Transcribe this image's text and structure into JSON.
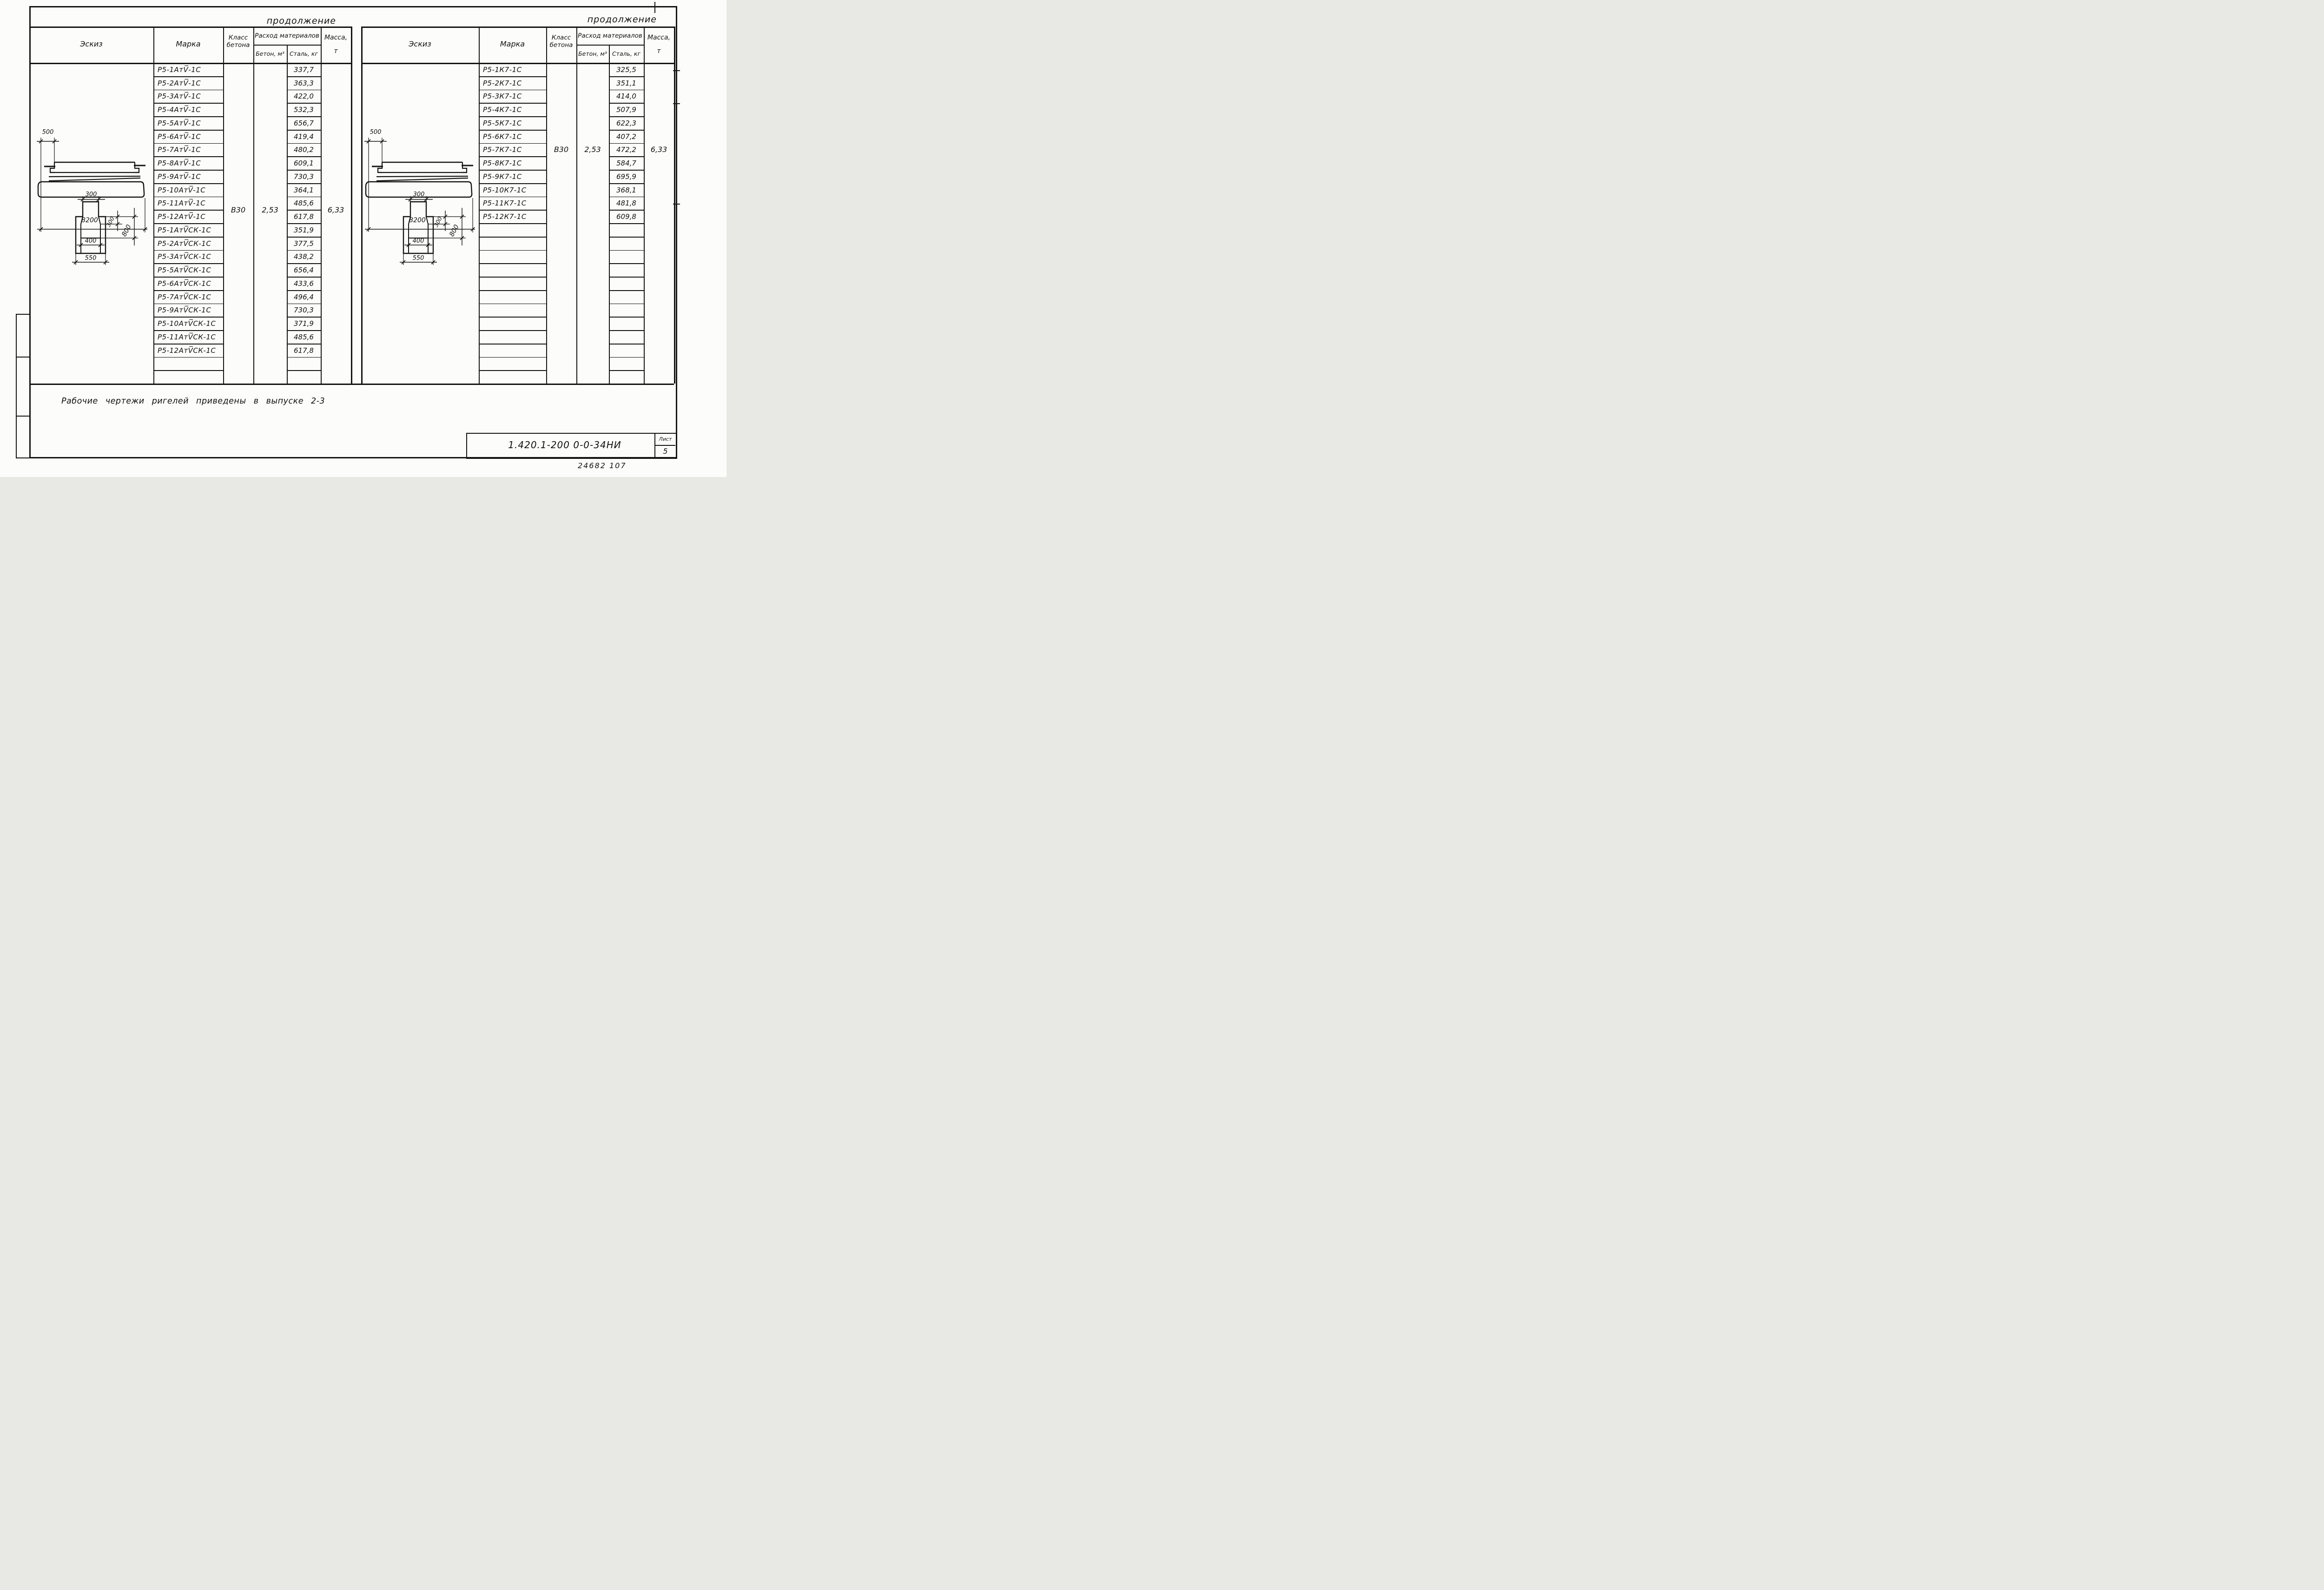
{
  "page": {
    "continuation_label": "продолжение",
    "note": "Рабочие  чертежи  ригелей  приведены  в  выпуске 2-3",
    "title_block": {
      "document_number": "1.420.1-200 0-0-34НИ",
      "sheet_label": "Лист",
      "sheet_number": "5",
      "stamp": "24682  107"
    }
  },
  "table_headers": {
    "sketch": "Эскиз",
    "mark": "Марка",
    "concrete_class": "Класс бетона",
    "materials": "Расход материалов",
    "concrete_m3": "Бетон, м³",
    "steel_kg": "Сталь, кг",
    "mass_t": "Масса, т"
  },
  "sketch_dimensions": {
    "end_offset": "500",
    "length": "8200",
    "top_width": "300",
    "ledge_height": "300",
    "section_height": "800",
    "inner_width": "400",
    "bottom_width": "550"
  },
  "left_table": {
    "concrete_class": "В30",
    "concrete_volume": "2,53",
    "mass": "6,33",
    "rows": [
      {
        "mark": "Р5-1АтV̅-1С",
        "steel": "337,7"
      },
      {
        "mark": "Р5-2АтV̅-1С",
        "steel": "363,3"
      },
      {
        "mark": "Р5-3АтV̅-1С",
        "steel": "422,0"
      },
      {
        "mark": "Р5-4АтV̅-1С",
        "steel": "532,3"
      },
      {
        "mark": "Р5-5АтV̅-1С",
        "steel": "656,7"
      },
      {
        "mark": "Р5-6АтV̅-1С",
        "steel": "419,4"
      },
      {
        "mark": "Р5-7АтV̅-1С",
        "steel": "480,2"
      },
      {
        "mark": "Р5-8АтV̅-1С",
        "steel": "609,1"
      },
      {
        "mark": "Р5-9АтV̅-1С",
        "steel": "730,3"
      },
      {
        "mark": "Р5-10АтV̅-1С",
        "steel": "364,1"
      },
      {
        "mark": "Р5-11АтV̅-1С",
        "steel": "485,6"
      },
      {
        "mark": "Р5-12АтV̅-1С",
        "steel": "617,8"
      },
      {
        "mark": "Р5-1АтV̅СК-1С",
        "steel": "351,9"
      },
      {
        "mark": "Р5-2АтV̅СК-1С",
        "steel": "377,5"
      },
      {
        "mark": "Р5-3АтV̅СК-1С",
        "steel": "438,2"
      },
      {
        "mark": "Р5-5АтV̅СК-1С",
        "steel": "656,4"
      },
      {
        "mark": "Р5-6АтV̅СК-1С",
        "steel": "433,6"
      },
      {
        "mark": "Р5-7АтV̅СК-1С",
        "steel": "496,4"
      },
      {
        "mark": "Р5-9АтV̅СК-1С",
        "steel": "730,3"
      },
      {
        "mark": "Р5-10АтV̅СК-1С",
        "steel": "371,9"
      },
      {
        "mark": "Р5-11АтV̅СК-1С",
        "steel": "485,6"
      },
      {
        "mark": "Р5-12АтV̅СК-1С",
        "steel": "617,8"
      }
    ]
  },
  "right_table": {
    "concrete_class": "В30",
    "concrete_volume": "2,53",
    "mass": "6,33",
    "rows": [
      {
        "mark": "Р5-1К7-1С",
        "steel": "325,5"
      },
      {
        "mark": "Р5-2К7-1С",
        "steel": "351,1"
      },
      {
        "mark": "Р5-3К7-1С",
        "steel": "414,0"
      },
      {
        "mark": "Р5-4К7-1С",
        "steel": "507,9"
      },
      {
        "mark": "Р5-5К7-1С",
        "steel": "622,3"
      },
      {
        "mark": "Р5-6К7-1С",
        "steel": "407,2"
      },
      {
        "mark": "Р5-7К7-1С",
        "steel": "472,2"
      },
      {
        "mark": "Р5-8К7-1С",
        "steel": "584,7"
      },
      {
        "mark": "Р5-9К7-1С",
        "steel": "695,9"
      },
      {
        "mark": "Р5-10К7-1С",
        "steel": "368,1"
      },
      {
        "mark": "Р5-11К7-1С",
        "steel": "481,8"
      },
      {
        "mark": "Р5-12К7-1С",
        "steel": "609,8"
      }
    ]
  }
}
